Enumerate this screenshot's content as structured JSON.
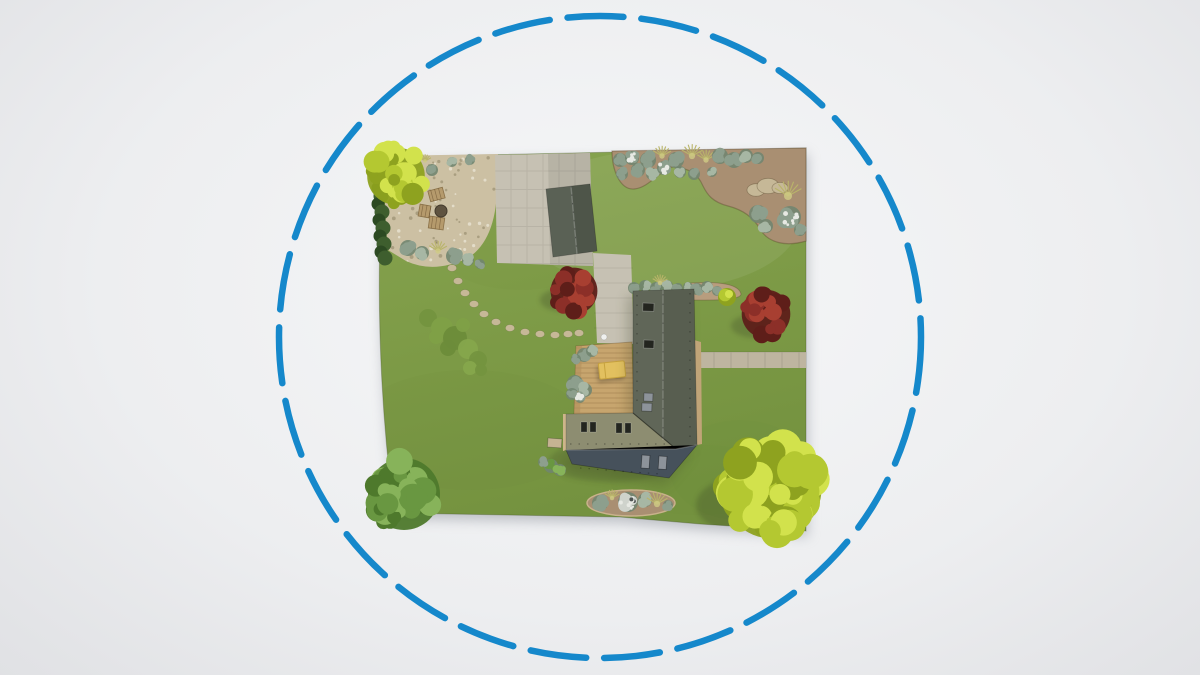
{
  "scene": {
    "title": "Aerial 3D view of a residential garden plot enclosed by a blue dashed circular boundary",
    "boundary_circle": {
      "cx": 600,
      "cy": 337,
      "r": 321,
      "color": "#1588cb",
      "stroke_width": 6.5,
      "dash_length": 56,
      "gap_length": 18
    },
    "palette": {
      "lawn_top": "#87a44f",
      "lawn_bottom": "#74923f",
      "lawn_patch": "#6d8a3a",
      "pavement": "#c6c1b3",
      "pavement_shadow": "#b0ac9f",
      "path_right": "#beb5a0",
      "gravel": "#ccc0a3",
      "gravel_dark": "#b5a887",
      "soil": "#a98f72",
      "soil_light": "#b89d7e",
      "roof_dark": "#585e50",
      "roof_khaki": "#8d8d71",
      "roof_slate": "#46515b",
      "shed_roof": "#4e5549",
      "wall": "#c0a478",
      "wall_light": "#cdb58a",
      "terrace": "#c7a56e",
      "terrace_dark": "#b2905c",
      "daybed": "#e2c05f",
      "daybed_dark": "#c7a23e",
      "tree_yellow": "#b4c831",
      "tree_yellow_light": "#d2e24c",
      "tree_yellow_dark": "#8ea21f",
      "tree_green": "#699741",
      "tree_green_light": "#87b35a",
      "tree_green_dark": "#4e792c",
      "bush_red": "#8c2f28",
      "bush_red_light": "#a83f31",
      "bush_red_dark": "#5e1e19",
      "shrub_sage": "#8d9f8d",
      "shrub_sage_light": "#a7b7a4",
      "shrub_sage_dark": "#718570",
      "flower_white": "#e7e9e3",
      "grass_tuft": "#b9b46a",
      "grass_tuft_light": "#cfcb85",
      "hedge": "#2c4a22",
      "hedge_light": "#3e5e2e",
      "stone": "#c6b897",
      "window_dark": "#23251f",
      "window_gray": "#8d939a",
      "shadow": "#343c22",
      "plot_drop_shadow": "#8d929b",
      "ball": "#eff0ee"
    },
    "geometry": {
      "plot": "M384,157 L806,148 L806,531 L700,524 L620,517 L394,513 Q371,335 384,157 Z",
      "gravel": "M386,156 L498,154 L497,176 Q499,238 468,258 Q434,274 406,261 L388,250 Q383,200 386,156 Z",
      "slab": "M495,155 L590,153 L593,266 L497,263 Z",
      "slab_shadow": "M548,154 L590,153 L593,266 L550,265 Z",
      "connector": "M593,253 L631,255 L634,344 L597,343 Z",
      "right_path": "M697,352 L806,352 L806,368 L697,368 Z",
      "top_bed": "M612,151 L806,148 L806,241 C786,247 768,243 760,229 C752,215 740,209 728,206 C712,202 707,194 703,186 C697,172 688,169 676,167 C664,165 650,188 634,189 C620,190 612,170 612,151 Z",
      "house_top_bed": "M690,283 Q738,280 741,294 Q741,301 694,300 Q687,290 690,283 Z",
      "shed": "M546,189 L590,184 L597,251 L553,257 Z",
      "shed_left": "M546,189 L571,186 L577,254 L553,257 Z",
      "shed_ridge": [
        571,
        186,
        577,
        254
      ],
      "terrace": "M576,346 L632,342 L634,414 L574,416 Z",
      "khaki_roof": "M566,414 L633,413 L676,449 L566,450 Z",
      "dark_roof": "M633,291 L694,289 L697,445 L676,449 L633,413 Z",
      "slate_roof": "M566,450 L676,449 L697,445 L669,478 L572,464 Z",
      "right_wall": "M694,340 L701,342 L702,444 L697,445 Z",
      "left_wall": "M563,414 L566,414 L566,450 L563,451 Z",
      "bottom_bed": {
        "cx": 631,
        "cy": 503,
        "rx": 44,
        "ry": 13
      },
      "daybed": {
        "x": 599,
        "y": 362,
        "w": 26,
        "h": 16,
        "rot": -6
      },
      "porch": {
        "x": 548,
        "y": 438,
        "w": 14,
        "h": 9,
        "rot": 4
      },
      "ball": {
        "cx": 604,
        "cy": 337,
        "r": 3
      },
      "roof_windows_dark": [
        [
          643,
          303,
          11,
          8
        ],
        [
          644,
          340,
          10,
          8
        ]
      ],
      "roof_windows_gray": [
        [
          644,
          393,
          9,
          8
        ],
        [
          642,
          403,
          10,
          8
        ]
      ],
      "khaki_windows": [
        [
          581,
          422
        ],
        [
          590,
          422
        ],
        [
          616,
          423
        ],
        [
          625,
          423
        ]
      ],
      "slate_windows": [
        [
          642,
          455
        ],
        [
          659,
          456
        ]
      ],
      "stepping_stones": [
        [
          452,
          268
        ],
        [
          458,
          281
        ],
        [
          465,
          293
        ],
        [
          474,
          304
        ],
        [
          484,
          314
        ],
        [
          496,
          322
        ],
        [
          510,
          328
        ],
        [
          525,
          332
        ],
        [
          540,
          334
        ],
        [
          555,
          335
        ],
        [
          568,
          334
        ],
        [
          579,
          333
        ]
      ],
      "hedge_blobs": [
        [
          378,
          188
        ],
        [
          381,
          196
        ],
        [
          378,
          204
        ],
        [
          382,
          212
        ],
        [
          379,
          220
        ],
        [
          383,
          228
        ],
        [
          380,
          236
        ],
        [
          384,
          244
        ],
        [
          381,
          252
        ],
        [
          385,
          258
        ]
      ],
      "furniture_chairs": [
        [
          429,
          189,
          15,
          11,
          -15
        ],
        [
          419,
          205,
          11,
          12,
          10
        ],
        [
          429,
          217,
          15,
          12,
          8
        ]
      ],
      "furniture_table": {
        "cx": 441,
        "cy": 211,
        "r": 6
      },
      "gravel_bushes": [
        [
          408,
          248,
          8,
          "sage"
        ],
        [
          422,
          253,
          7,
          "sage_light"
        ],
        [
          438,
          251,
          6,
          "grass"
        ],
        [
          454,
          256,
          8,
          "sage"
        ],
        [
          468,
          260,
          6,
          "sage_light"
        ],
        [
          480,
          264,
          5,
          "sage"
        ],
        [
          432,
          170,
          6,
          "sage"
        ],
        [
          452,
          162,
          5,
          "sage_light"
        ],
        [
          470,
          160,
          5,
          "sage"
        ],
        [
          425,
          161,
          4,
          "grass"
        ]
      ],
      "top_bed_plants": [
        [
          620,
          160,
          7,
          "sage"
        ],
        [
          622,
          174,
          6,
          "sage"
        ],
        [
          632,
          158,
          7,
          "white"
        ],
        [
          638,
          170,
          7,
          "sage"
        ],
        [
          648,
          160,
          8,
          "sage"
        ],
        [
          652,
          174,
          6,
          "sage_light"
        ],
        [
          662,
          156,
          6,
          "grass"
        ],
        [
          664,
          168,
          7,
          "white"
        ],
        [
          676,
          160,
          8,
          "sage"
        ],
        [
          680,
          172,
          6,
          "sage_light"
        ],
        [
          692,
          156,
          7,
          "grass"
        ],
        [
          694,
          174,
          6,
          "sage"
        ],
        [
          706,
          160,
          6,
          "grass"
        ],
        [
          712,
          172,
          5,
          "sage_light"
        ],
        [
          720,
          156,
          8,
          "sage"
        ],
        [
          734,
          160,
          8,
          "sage"
        ],
        [
          746,
          156,
          7,
          "sage_light"
        ],
        [
          758,
          158,
          6,
          "sage"
        ],
        [
          756,
          190,
          9,
          "rock"
        ],
        [
          768,
          186,
          11,
          "rock"
        ],
        [
          780,
          188,
          8,
          "rock"
        ],
        [
          788,
          196,
          9,
          "grass"
        ],
        [
          790,
          217,
          11,
          "white"
        ],
        [
          758,
          214,
          9,
          "sage"
        ],
        [
          766,
          226,
          7,
          "sage_light"
        ],
        [
          800,
          230,
          6,
          "sage"
        ]
      ],
      "house_top_shrubs": [
        [
          634,
          288,
          6,
          "sage"
        ],
        [
          645,
          286,
          6,
          "sage_light"
        ],
        [
          656,
          288,
          6,
          "sage"
        ],
        [
          667,
          286,
          6,
          "sage_light"
        ],
        [
          678,
          288,
          5,
          "sage"
        ],
        [
          688,
          287,
          5,
          "sage_light"
        ],
        [
          660,
          283,
          5,
          "grass"
        ],
        [
          697,
          289,
          6,
          "sage"
        ],
        [
          707,
          287,
          6,
          "sage_light"
        ],
        [
          717,
          291,
          5,
          "sage"
        ]
      ],
      "terrace_bushes": [
        [
          584,
          355,
          7,
          "sage"
        ],
        [
          592,
          351,
          6,
          "sage_light"
        ],
        [
          576,
          359,
          5,
          "sage"
        ],
        [
          575,
          383,
          8,
          "sage"
        ],
        [
          585,
          390,
          7,
          "sage_light"
        ],
        [
          572,
          394,
          6,
          "sage"
        ],
        [
          580,
          398,
          5,
          "white"
        ]
      ],
      "house_left_bushes": [
        [
          551,
          466,
          7,
          "green"
        ],
        [
          560,
          470,
          6,
          "green_light"
        ],
        [
          543,
          462,
          5,
          "sage"
        ]
      ],
      "bottom_bed_plants": [
        [
          600,
          503,
          8,
          "sage"
        ],
        [
          612,
          498,
          5,
          "grass"
        ],
        [
          628,
          502,
          10,
          "whitemix"
        ],
        [
          645,
          500,
          7,
          "sage_light"
        ],
        [
          657,
          504,
          7,
          "grass"
        ],
        [
          668,
          505,
          5,
          "sage"
        ]
      ],
      "shrub_patch": [
        [
          428,
          318,
          9
        ],
        [
          442,
          328,
          11
        ],
        [
          455,
          338,
          12
        ],
        [
          468,
          349,
          10
        ],
        [
          478,
          360,
          9
        ],
        [
          463,
          325,
          7
        ],
        [
          448,
          348,
          8
        ],
        [
          470,
          368,
          7
        ],
        [
          481,
          370,
          6
        ],
        [
          436,
          337,
          7
        ]
      ],
      "yellow_bush": {
        "cx": 727,
        "cy": 297,
        "r": 9
      },
      "trees": [
        {
          "name": "tree-yellow-top-left",
          "cx": 396,
          "cy": 176,
          "r": 32,
          "count": 36,
          "kind": "yellow",
          "seed": 7
        },
        {
          "name": "tree-green-bottom-left",
          "cx": 404,
          "cy": 494,
          "r": 40,
          "count": 42,
          "kind": "green",
          "seed": 11
        },
        {
          "name": "tree-yellow-bottom-right",
          "cx": 772,
          "cy": 489,
          "r": 55,
          "count": 62,
          "kind": "yellow",
          "seed": 3
        }
      ],
      "red_bushes": [
        {
          "cx": 574,
          "cy": 291,
          "r": 26,
          "count": 22,
          "seed": 5
        },
        {
          "cx": 766,
          "cy": 314,
          "r": 27,
          "count": 22,
          "seed": 9
        }
      ],
      "shadows": [
        {
          "cx": 398,
          "cy": 203,
          "rx": 30,
          "ry": 13,
          "o": 0.28
        },
        {
          "cx": 392,
          "cy": 508,
          "rx": 36,
          "ry": 16,
          "o": 0.3
        },
        {
          "cx": 752,
          "cy": 505,
          "rx": 56,
          "ry": 30,
          "o": 0.25
        },
        {
          "cx": 566,
          "cy": 300,
          "rx": 26,
          "ry": 12,
          "o": 0.25
        },
        {
          "cx": 757,
          "cy": 326,
          "rx": 26,
          "ry": 12,
          "o": 0.25
        },
        {
          "cx": 554,
          "cy": 250,
          "rx": 30,
          "ry": 12,
          "o": 0.3
        },
        {
          "cx": 610,
          "cy": 462,
          "rx": 62,
          "ry": 20,
          "o": 0.18
        }
      ]
    }
  }
}
